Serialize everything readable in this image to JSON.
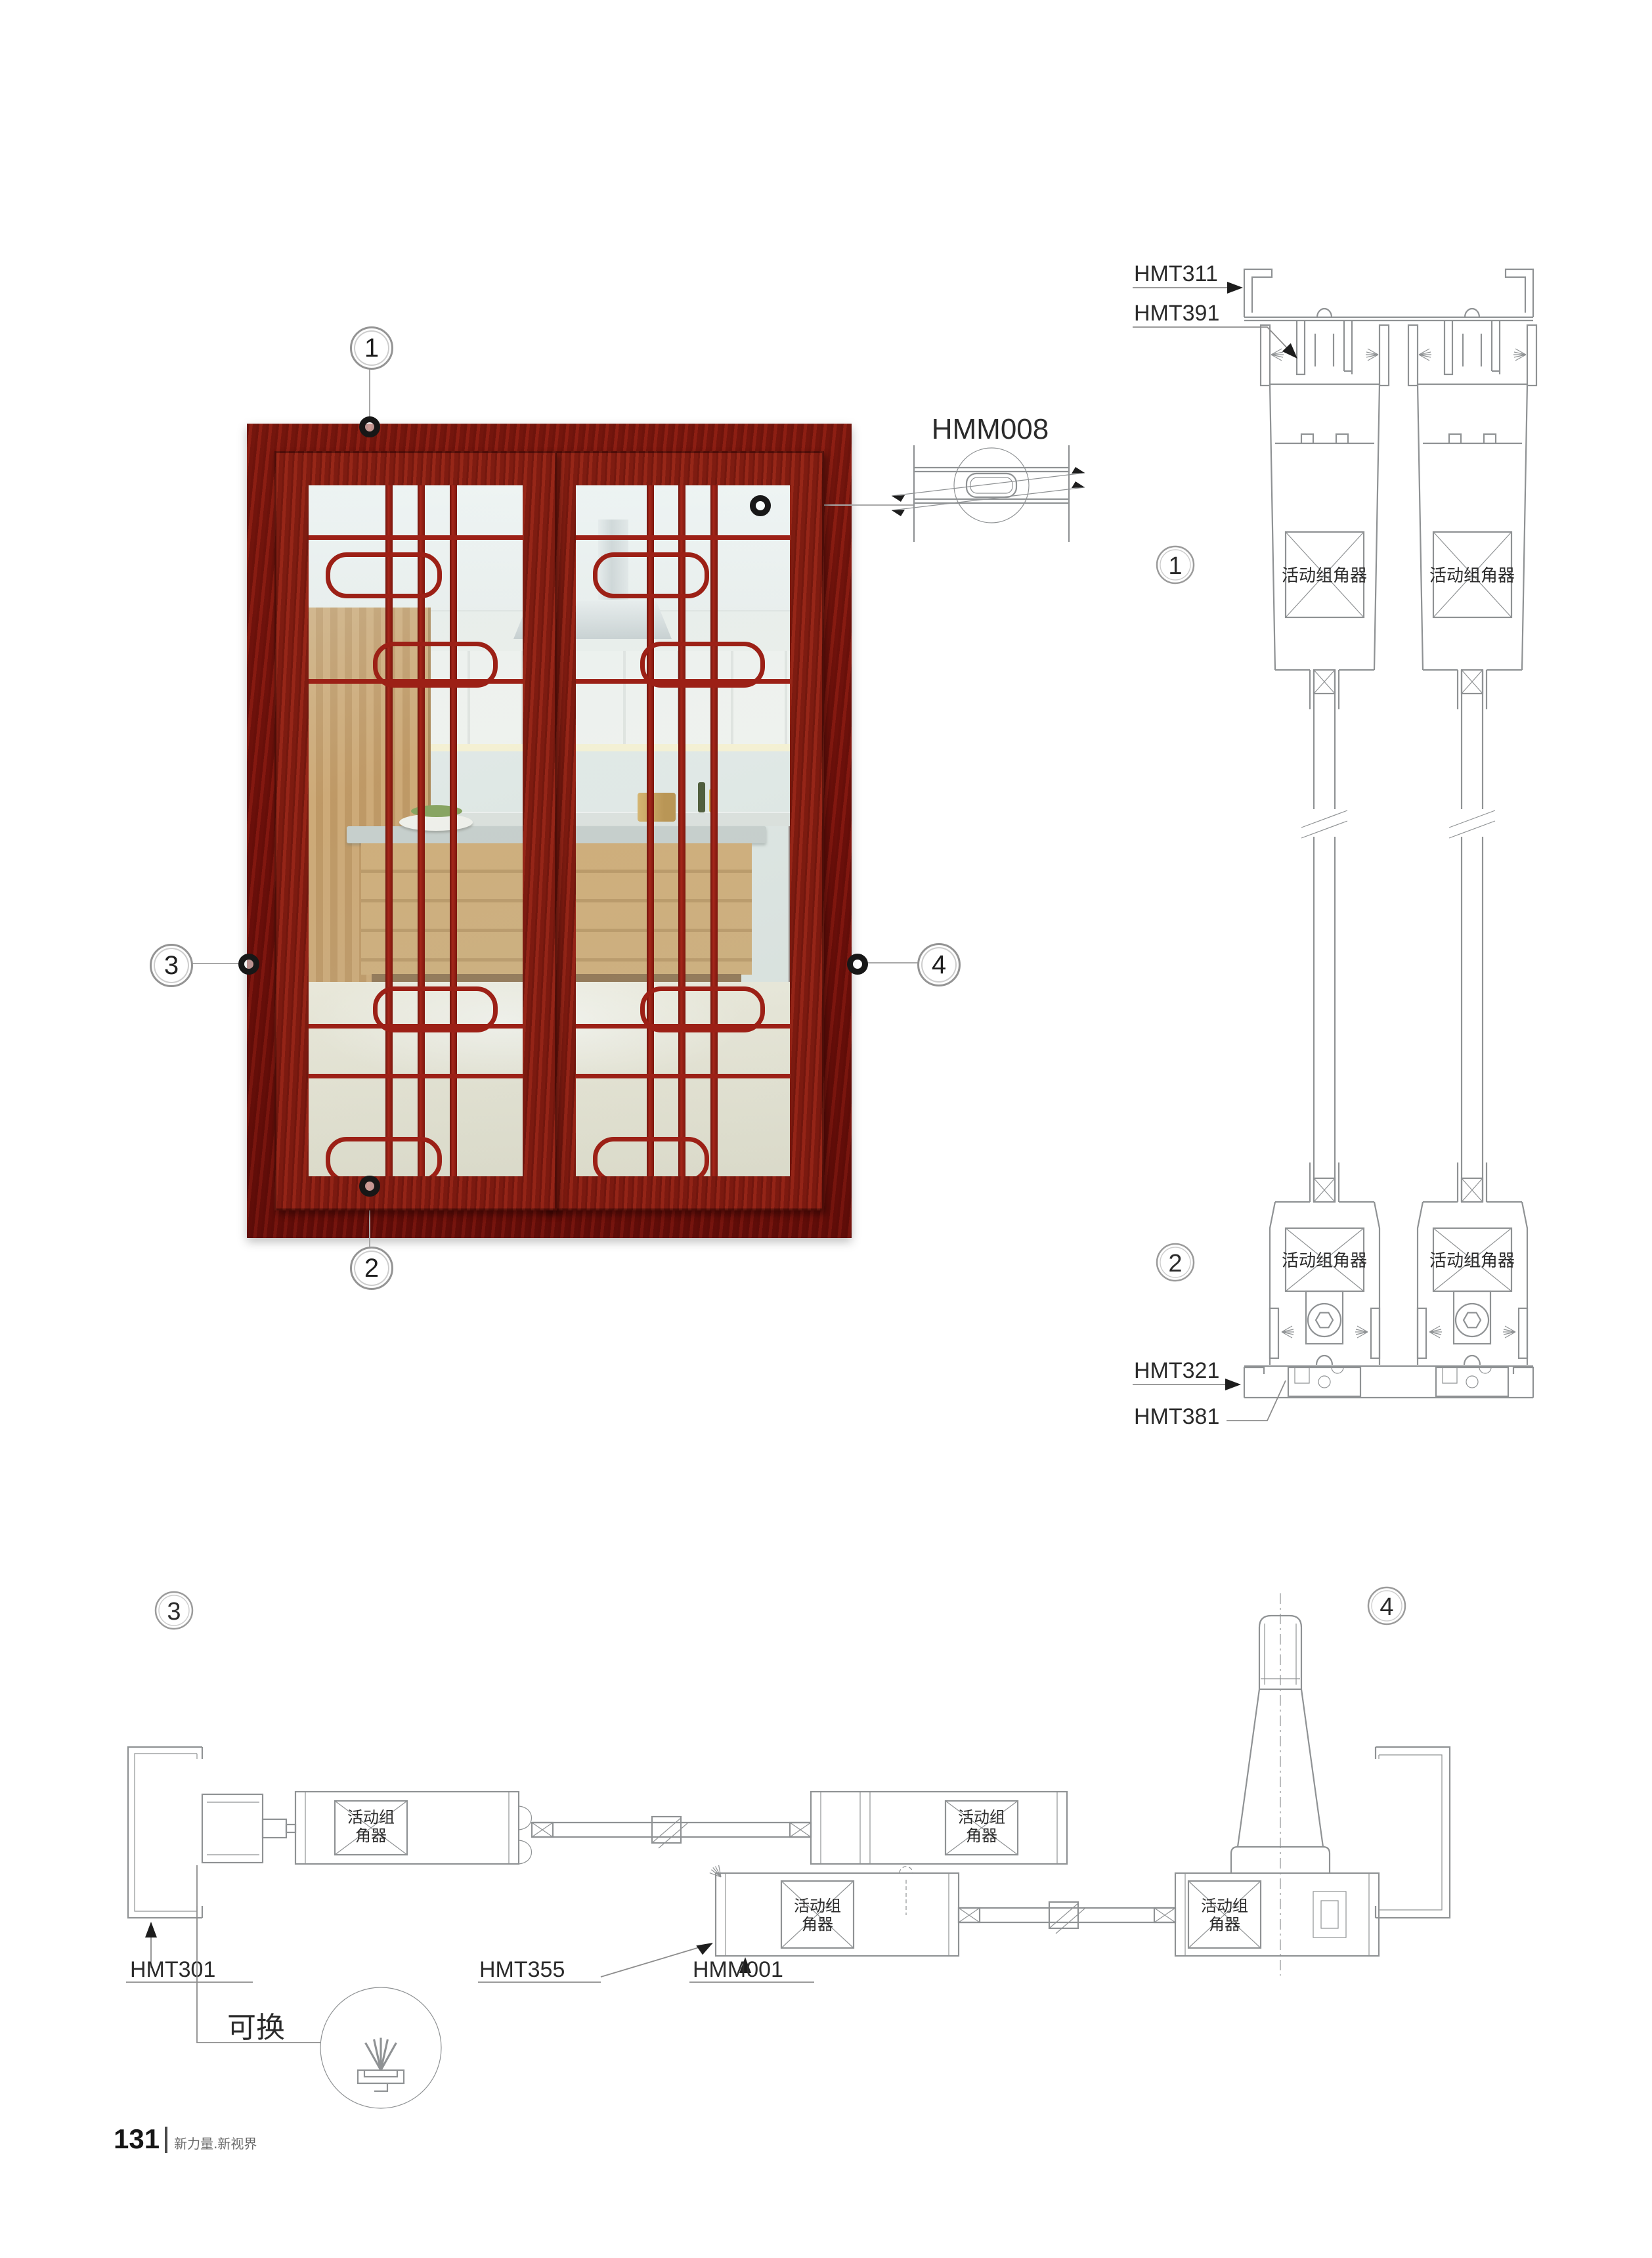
{
  "photo": {
    "callouts": [
      {
        "n": "1"
      },
      {
        "n": "2"
      },
      {
        "n": "3"
      },
      {
        "n": "4"
      }
    ],
    "detail_code": "HMM008"
  },
  "vertical_section": {
    "callout_top": "1",
    "callout_bottom": "2",
    "label_top_outer": "HMT311",
    "label_top_inner": "HMT391",
    "label_bottom_outer": "HMT321",
    "label_bottom_inner": "HMT381",
    "corner_connector": "活动组角器"
  },
  "horizontal_section": {
    "callout_left": "3",
    "callout_right": "4",
    "label_left_jamb": "HMT301",
    "label_interlock": "HMT355",
    "label_sash": "HMM001",
    "replaceable": "可换",
    "corner_connector_line1": "活动组",
    "corner_connector_line2": "角器"
  },
  "footer": {
    "page_number": "131",
    "tagline": "新力量.新视界"
  },
  "colors": {
    "frame_wood_red": "#8c1b12",
    "grille_red": "#9c2016",
    "drawing_line": "#8f9294",
    "callout_line": "#a9a9a9",
    "text": "#2b2b2b"
  }
}
